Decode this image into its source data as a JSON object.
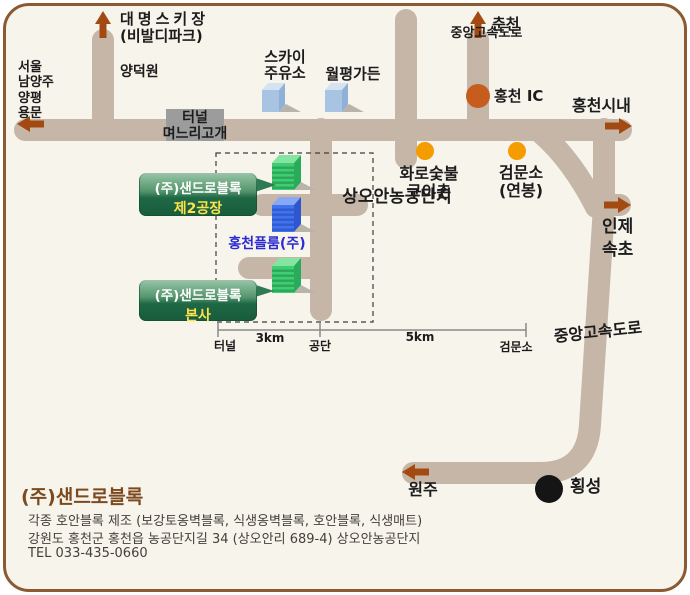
{
  "colors": {
    "background": "#f7f4ec",
    "border": "#8a5a33",
    "road": "#c5b6a8",
    "arrow": "#a34a12",
    "orange_marker": "#f59c00",
    "ic_marker": "#c65c1d",
    "black_marker": "#151515",
    "tunnel_box": "#9c9c9c",
    "sign_green": "#1b6040",
    "sign_sub_text": "#ffe14a",
    "plume_text": "#2b2bd0"
  },
  "map": {
    "resort": {
      "line1": "대명스키장",
      "line2": "(비발디파크)"
    },
    "west_destinations": [
      "서울",
      "남양주",
      "양평",
      "용문"
    ],
    "yangdeokwon": "양덕원",
    "tunnel": {
      "line1": "터널",
      "line2": "며느리고개"
    },
    "sky_gas": {
      "line1": "스카이",
      "line2": "주유소"
    },
    "wolpyeong": "월평가든",
    "expressway_north": {
      "road": "중앙고속도로",
      "direction": "춘천",
      "ic": "홍천 IC"
    },
    "downtown": "홍천시내",
    "hwaro": {
      "line1": "화로숯불",
      "line2": "구이촌"
    },
    "checkpoint": {
      "line1": "검문소",
      "line2": "(연봉)"
    },
    "east": {
      "line1": "인제",
      "line2": "속초"
    },
    "complex_zone": "상오안농공단지",
    "plume": "홍천플룸(주)",
    "sign_factory2": {
      "company": "(주)샌드로블록",
      "name": "제2공장"
    },
    "sign_hq": {
      "company": "(주)샌드로블록",
      "name": "본사"
    },
    "expressway_south": {
      "road": "중앙고속도로",
      "wonju": "원주",
      "hoengseong": "횡성"
    },
    "scale": {
      "t1": "터널",
      "t2": "공단",
      "t3": "검문소",
      "d1": "3km",
      "d2": "5km"
    }
  },
  "footer": {
    "company": "(주)샌드로블록",
    "products": "각종 호안블록 제조 (보강토옹벽블록, 식생옹벽블록, 호안블록, 식생매트)",
    "address": "강원도 홍천군 홍천읍 농공단지길 34 (상오안리 689-4) 상오안농공단지",
    "tel": "TEL  033-435-0660"
  }
}
